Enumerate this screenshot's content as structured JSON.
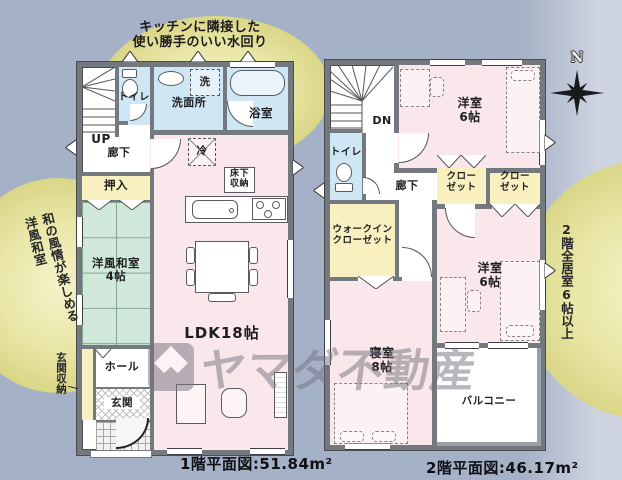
{
  "background": {
    "left_color": "#a4b1c6",
    "right_color": "#ced4e0",
    "highlight_ellipse_color": "#e9e6a6"
  },
  "palette": {
    "wall": "#74787f",
    "room_pink": "#f9e7ec",
    "wet_area_blue": "#cfe7f5",
    "closet_yellow": "#f8f0bf",
    "tatami_green": "#cfe8da"
  },
  "watermark": {
    "brand": "ヤマダ不動産"
  },
  "compass": {
    "label": "N"
  },
  "annotations": {
    "top": "キッチンに隣接した\n使い勝手のいい水回り",
    "left": "和の風情が楽しめる\n洋風和室",
    "right": "2階全居室6帖以上"
  },
  "floor1": {
    "caption": "1階平面図:51.84m²",
    "labels": {
      "up": "UP",
      "hallway": "廊下",
      "toilet": "トイレ",
      "washroom": "洗面所",
      "washer": "洗",
      "bath": "浴室",
      "fridge": "冷",
      "floor_storage": "床下\n収納",
      "futon_closet": "押入",
      "tatami_room": "洋風和室\n4帖",
      "ldk": "LDK18帖",
      "hall": "ホール",
      "entrance": "玄関",
      "entrance_storage": "玄関収納"
    }
  },
  "floor2": {
    "caption": "2階平面図:46.17m²",
    "labels": {
      "down": "DN",
      "toilet": "トイレ",
      "hallway": "廊下",
      "bedroom_north": "洋室\n6帖",
      "closet_a": "クロー\nゼット",
      "closet_b": "クロー\nゼット",
      "walk_in_closet": "ウォークイン\nクローゼット",
      "master_bedroom": "寝室\n8帖",
      "bedroom_south": "洋室\n6帖",
      "balcony": "バルコニー"
    }
  }
}
